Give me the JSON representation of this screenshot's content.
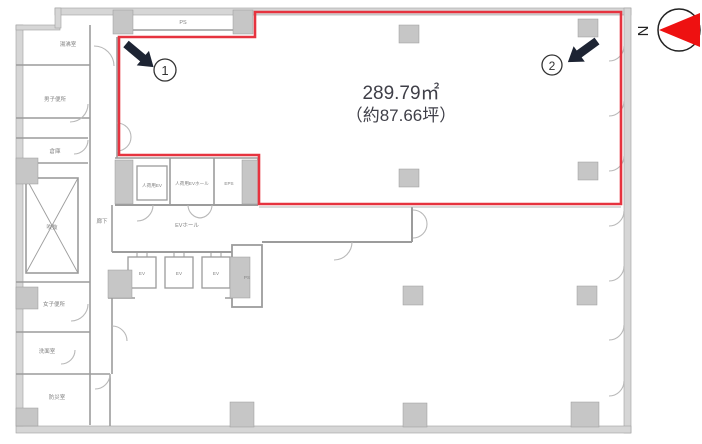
{
  "floor_plan": {
    "area": {
      "sqm": "289.79㎡",
      "tsubo": "（約87.66坪）"
    },
    "markers": {
      "one": "1",
      "two": "2"
    },
    "compass": {
      "north": "N"
    },
    "labels": {
      "ps_top": "PS",
      "pantry": "湯沸室",
      "mens_toilet": "男子便所",
      "storage": "倉庫",
      "void_shaft": "吹抜",
      "corridor": "廊下",
      "freight_ev": "人荷用EV",
      "freight_ev_hall": "人荷用EVホール",
      "eps": "EPS",
      "ev_hall": "EVホール",
      "ev": "EV",
      "ps_center": "PS",
      "womens_toilet": "女子便所",
      "washroom": "洗面室",
      "disaster_room": "防災室"
    },
    "colors": {
      "boundary": "#e6333f",
      "needle": "#ee1111",
      "arrow": "#1d2433"
    }
  }
}
